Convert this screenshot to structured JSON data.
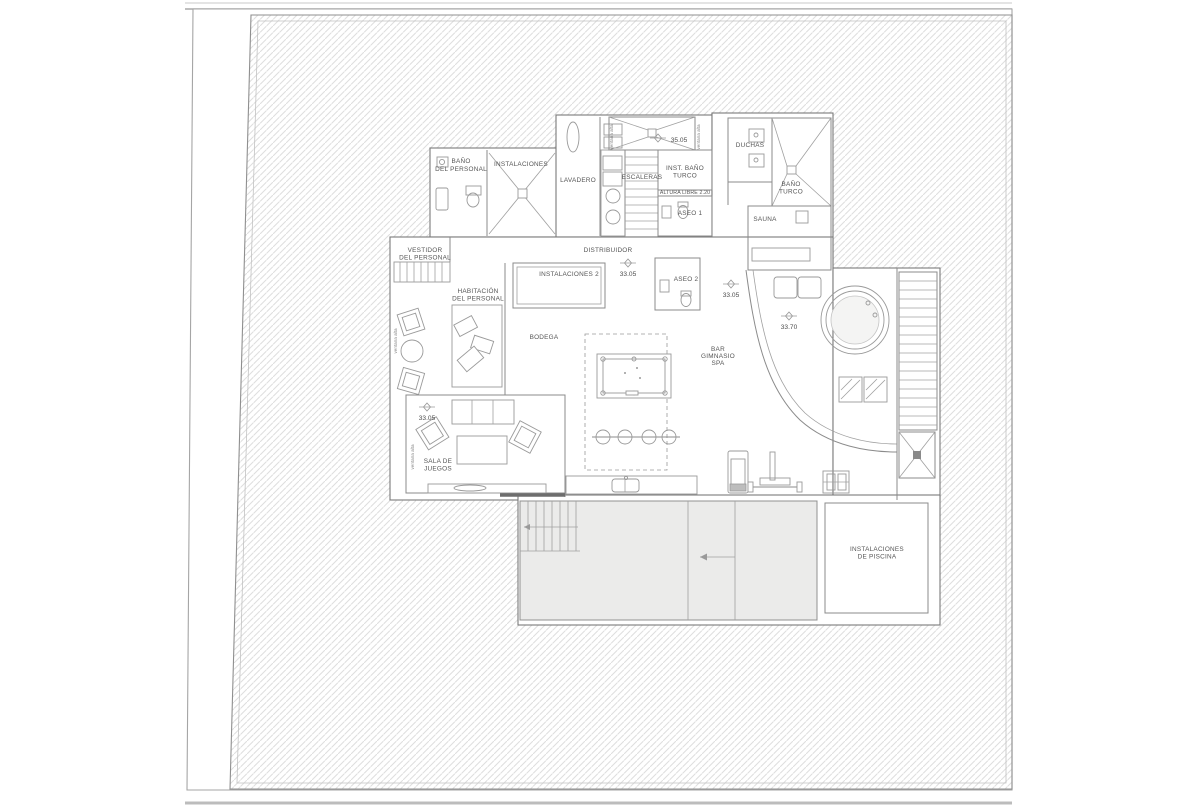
{
  "drawing": {
    "kind": "architectural floor plan (scanned)",
    "floor_use": "spa / pool basement level with staff rooms"
  },
  "rooms": {
    "bano_personal": {
      "lines": [
        "BAÑO",
        "DEL PERSONAL"
      ]
    },
    "instalaciones": {
      "lines": [
        "INSTALACIONES"
      ]
    },
    "lavadero": {
      "lines": [
        "LAVADERO"
      ]
    },
    "escaleras": {
      "lines": [
        "ESCALERAS"
      ]
    },
    "inst_bano_turco": {
      "lines": [
        "INST. BAÑO",
        "TURCO"
      ]
    },
    "altura_libre": {
      "lines": [
        "ALTURA LIBRE 2.20"
      ]
    },
    "aseo1": {
      "lines": [
        "ASEO 1"
      ]
    },
    "duchas": {
      "lines": [
        "DUCHAS"
      ]
    },
    "bano_turco": {
      "lines": [
        "BAÑO",
        "TURCO"
      ]
    },
    "sauna": {
      "lines": [
        "SAUNA"
      ]
    },
    "vestidor": {
      "lines": [
        "VESTIDOR",
        "DEL PERSONAL"
      ]
    },
    "distribuidor": {
      "lines": [
        "DISTRIBUIDOR"
      ]
    },
    "instalaciones2": {
      "lines": [
        "INSTALACIONES 2"
      ]
    },
    "habitacion": {
      "lines": [
        "HABITACIÓN",
        "DEL PERSONAL"
      ]
    },
    "bodega": {
      "lines": [
        "BODEGA"
      ]
    },
    "aseo2": {
      "lines": [
        "ASEO 2"
      ]
    },
    "bar_gimnasio_spa": {
      "lines": [
        "BAR",
        "GIMNASIO",
        "SPA"
      ]
    },
    "sala_juegos": {
      "lines": [
        "SALA DE",
        "JUEGOS"
      ]
    },
    "inst_piscina": {
      "lines": [
        "INSTALACIONES",
        "DE PISCINA"
      ]
    }
  },
  "levels": [
    {
      "id": "upper-stair-landing",
      "value": "35.05"
    },
    {
      "id": "distribuidor",
      "value": "33.05"
    },
    {
      "id": "spa-corridor",
      "value": "33.05"
    },
    {
      "id": "terrace-jacuzzi",
      "value": "33.70"
    },
    {
      "id": "sala-de-juegos",
      "value": "33.05"
    }
  ],
  "annotations": {
    "ventana_alta": "ventana alta"
  },
  "colors": {
    "paper": "#ffffff",
    "ink": "#7a7a7a",
    "hatch": "#dedede",
    "pool_fill": "#ebebea",
    "text": "#555555"
  }
}
